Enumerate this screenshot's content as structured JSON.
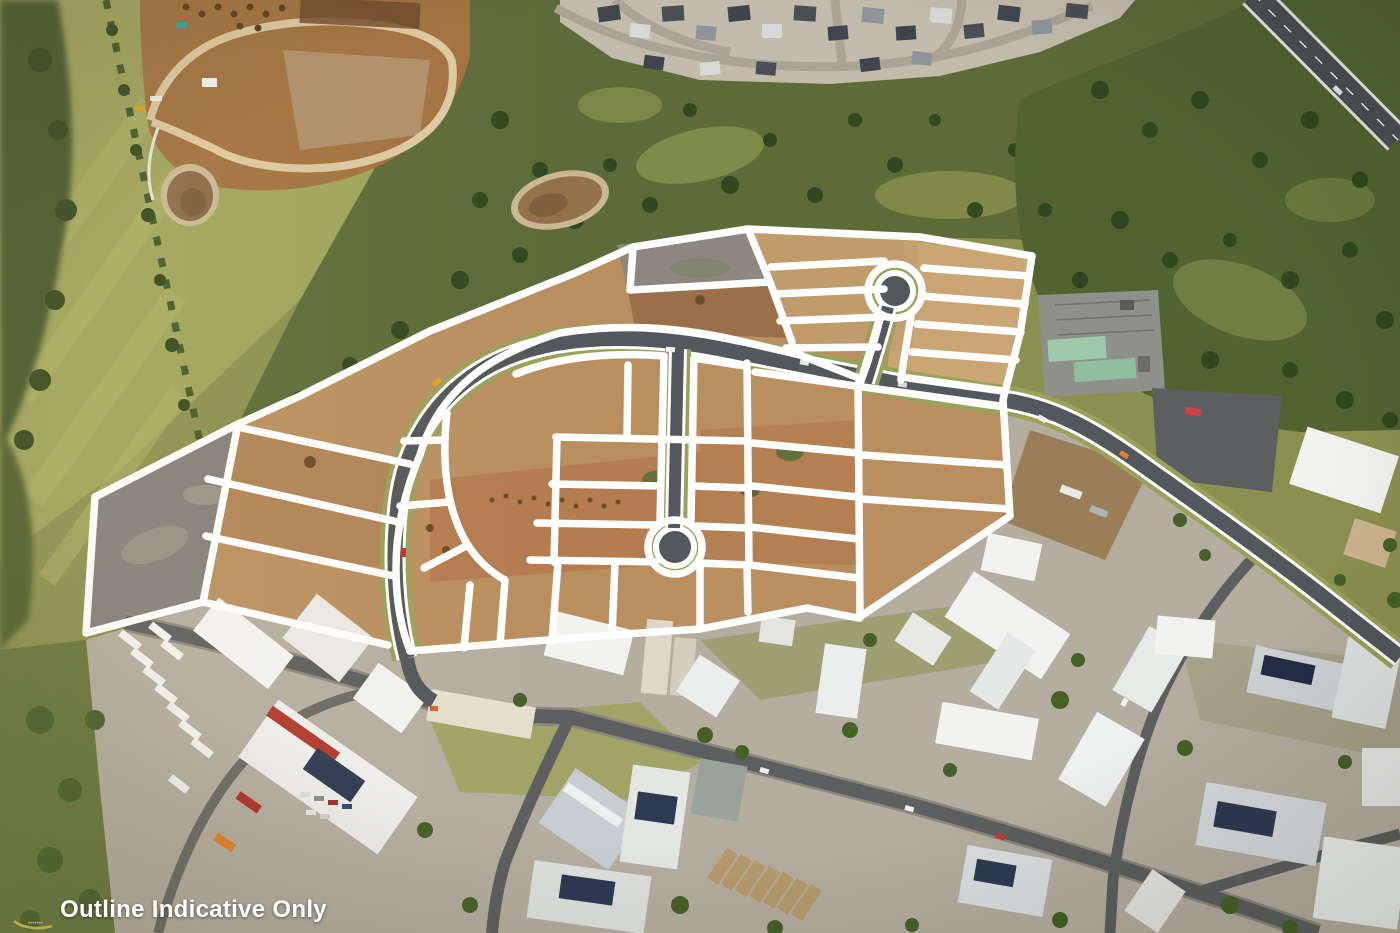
{
  "meta": {
    "type": "aerial-photograph",
    "description": "Oblique drone aerial photo of a master-planned industrial land estate under construction, with indicative lot boundaries overlaid as thick white lines. Surrounding context: green paddocks and tree belt (west), residential estate and bushland (north), electrical substation (east), established industrial precinct with white-roofed warehouses (south)."
  },
  "overlay": {
    "disclaimer": "Outline Indicative Only",
    "watermark": "photographer-swoosh-logo"
  },
  "scene": {
    "features": [
      "white-lot-outline-overlay",
      "loop-road-with-two-cul-de-sacs",
      "cleared-earthworks-lots",
      "electrical-substation",
      "industrial-warehouses",
      "residential-estate",
      "construction-site-with-sediment-ponds",
      "highway"
    ],
    "colors": {
      "lot_outline": "#ffffff",
      "asphalt": "#54575b",
      "road_edge_line": "#ffffff",
      "road_verge": "#9aa158",
      "dirt_tan": "#b98f60",
      "dirt_light": "#cdaa79",
      "dirt_red": "#b06e42",
      "cleared_gray_pad": "#83807a",
      "grass_olive": "#8a9150",
      "field_yellow_green": "#a3a85e",
      "bushland": "#5d6b38",
      "tree_dark": "#35491f",
      "industrial_ground": "#b5aea0",
      "roof_white": "#f2f2f0",
      "solar_panel": "#2e3a52",
      "substation_roof": "#9ec9ad",
      "gravel_dark": "#5c5e60",
      "pond_brown": "#8a6a47"
    }
  }
}
